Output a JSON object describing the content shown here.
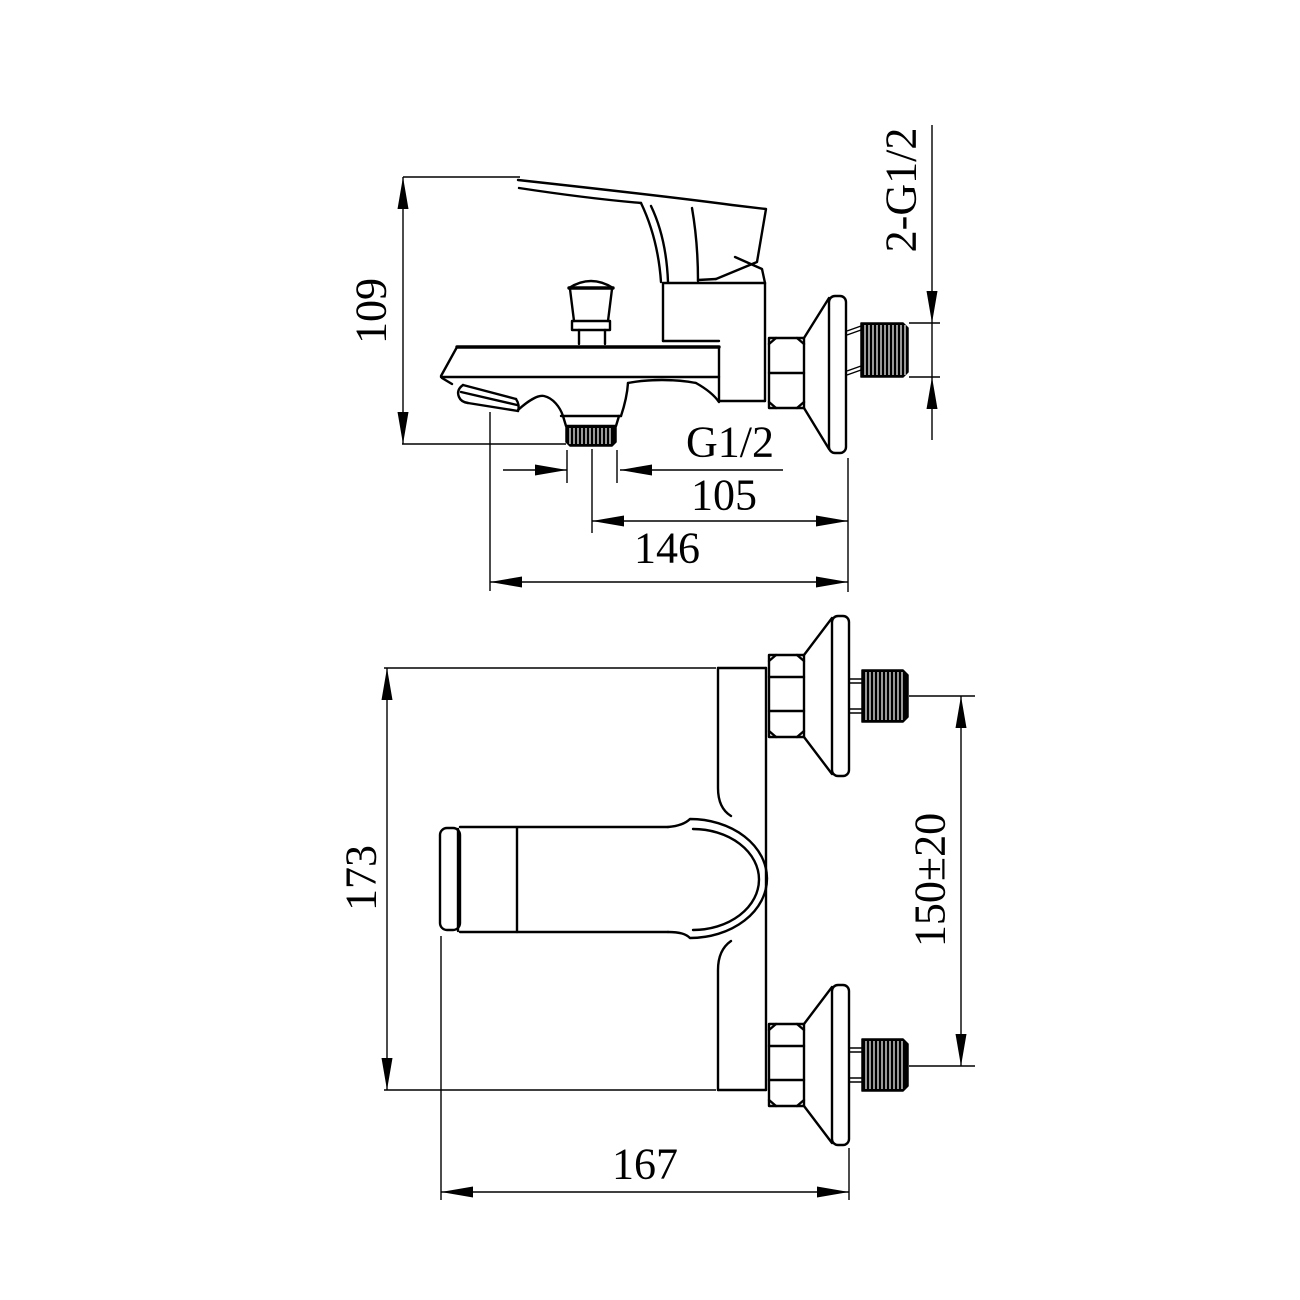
{
  "drawing": {
    "type": "technical dimension drawing",
    "subject": "wall-mounted bath shower mixer faucet",
    "colors": {
      "background": "#ffffff",
      "line": "#000000"
    }
  },
  "views": {
    "side_view": {
      "name": "side elevation",
      "dimensions": {
        "height": "109",
        "outlet_thread": "G1/2",
        "outlet_to_wall": "105",
        "spout_to_wall": "146",
        "inlet_threads": "2-G1/2"
      }
    },
    "front_view": {
      "name": "front elevation",
      "dimensions": {
        "height": "173",
        "inlet_spacing": "150±20",
        "width": "167"
      }
    }
  }
}
